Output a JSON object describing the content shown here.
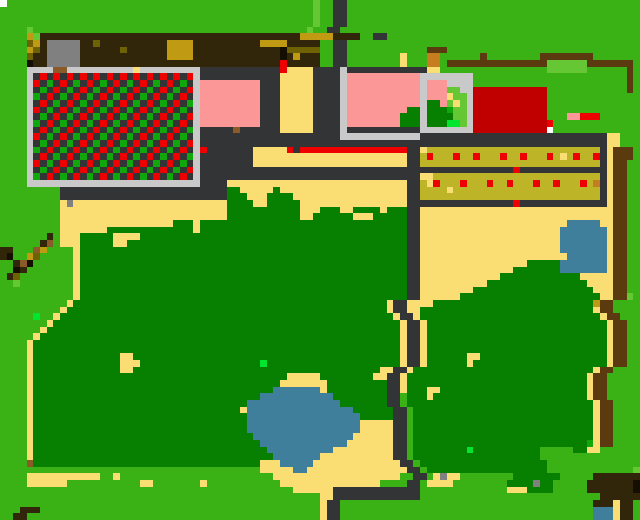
{
  "map": {
    "cols": 96,
    "rows": 78,
    "palette": {
      "G": "#3ab114",
      "D": "#077f00",
      "g": "#10a70d",
      "L": "#66c734",
      "N": "#00e62e",
      "S": "#fbde73",
      "R": "#333436",
      "W": "#c9c9c9",
      "P": "#fb9797",
      "r": "#ee0000",
      "C": "#c00000",
      "o": "#bdb427",
      "d": "#6e6204",
      "m": "#c09a12",
      "B": "#5b3a10",
      "h": "#312609",
      "b": "#8a5a28",
      "K": "#140f02",
      "t": "#808080",
      "U": "#3f7f9c",
      "O": "#c57d20",
      "w": "#ffffff"
    },
    "legend": {
      "G": "grass",
      "D": "forest",
      "g": "green-tile",
      "L": "bush-lime",
      "N": "item-green",
      "S": "sand-path",
      "R": "road-dark",
      "W": "stone-walkway",
      "P": "pink-roof",
      "r": "red-marker",
      "C": "red-building",
      "o": "crop-row",
      "d": "dark-olive",
      "m": "gold-leaf",
      "B": "wood-fence",
      "h": "dark-roof",
      "b": "dirt",
      "K": "shadow",
      "t": "rock-gray",
      "U": "water",
      "O": "crate-orange",
      "w": "map-dot"
    },
    "grid": [
      "wGGGGGGGGGGGGGGGGGGGGGGGGGGGGGGGGGGGGGGGGGGGGGGLGGRRGGGGGGGGGGGGGGGGGGGGGGGGGGGGGGGGGGGGGGGGGGGG",
      "GGGGGGGGGGGGGGGGGGGGGGGGGGGGGGGGGGGGGGGGGGGGGGGLGGRRGGGGGGGGGGGGGGGGGGGGGGGGGGGGGGGGGGGGGGGGGGGG",
      "GGGGGGGGGGGGGGGGGGGGGGGGGGGGGGGGGGGGGGGGGGGGGGGLGGRRGGGGGGGGGGGGGGGGGGGGGGGGGGGGGGGGGGGGGGGGGGGG",
      "GGGGGGGGGGGGGGGGGGGGGGGGGGGGGGGGGGGGGGGGGGGGGGGLGGRRGGGGGGGGGGGGGGGGGGGGGGGGGGGGGGGGGGGGGGGGGGGG",
      "GGGGLGGGGGGGGGGGGGGGGGGGGGGGGGGGGGGGGGGGGGGGGGLGGRRGGGGGGGGGGGGGGGGGGGGGGGGGGGGGGGGGGGGGGGGGGGG",
      "GGGGmLhhhhhhhhhhhhhhhhhhhhhhhhhhhhhhhhhhhhhhhmmmmmhhhhGGRRGGGGGGGGGGGGGGGGGGGGGGGGGGGGGGGGGGGGGGGG",
      "GGGGdmhttttthhdhhhhhhhhhhmmmmhhhhhhhhhhmmmmhhhhhGGRRGGGGGGGGGGGGGGGGGGGGGGGGGGGGGGGGGGGGGGGG",
      "GGGGmdhttttthhhhhhdhhhhhhmmmmhhhhhhhhhhhhhKdddddGGRRGGGGGGGGGGGGBBBGGGGGGGGGGGGGGGGGGGGGGGGGGGGG",
      "GGGGdhhttttthhhhhhhhhhhhhmmmmhhhhhhhhhhhhhKhmhhhGGRRGGGGGGGGSGGGOOGGGGGGBGGGGGGGGBBBBBBBBGGGGGGG",
      "GGGGKhhttttthhhhhhhhhhhhhhhhhhhhhhhhhhhhhhrhhhhhGGRRGGGGGGGGSGGGOOGBBBBBBBBBBBBBBBLLLLLLBBBBBBBG",
      "GGGGWWWWbbWWWWWWWWWWSWWWWWWWWWRRRRRRRRRRRRrSSSSRRRRWRRRRRRRRRRRRSSGGGGGGGGGGGGGGGGLLLLLLGGGGGGBG",
      "GGGGWRrRrRrRrRrRrRrRrRrRrRrRrWRRRRRRRRRRRRSSSSSRRRRWPPPPPPPPPPPWWWWWWWWGGGGGGGGGGGGGGGGGGGGGGGBG",
      "GGGGWrRgRrRgRrRgRrRgRrRgRrRgRWPPPPPPPPPRRRSSSSSRRRRWPPPPPPPPPPPWPPPWWWWGGGGGGGGGGGGGGGGGGGGGGGBG",
      "GGGGWRgRrRgRrRgRrRgRrRgRrRgRrWPPPPPPPPPRRRSSSSSRRRRWPPPPPPPPPPPWPPPLLWWCCCCCCCCCCCGGGGGGGGGGGGBG",
      "GGGGWgRrRgRrRgRrRgRrRgRrRgRrRWPPPPPPPPPRRRSSSSSRRRRWPPPPPPPPPPPWPPPSLLWCCCCCCCCCCCGGGGGGGGGGGGGG",
      "GGGGWRrRgRrRgRrRgRrRgRrRgRrRgWPPPPPPPPPRRRSSSSSRRRRWPPPPPPPPPPPWDDPLSLWCCCCCCCCCCCGGGGGGGGGGGGGG",
      "GGGGWrRgRrRgRrRgRrRgRrRgRrRgRWPPPPPPPPPRRRSSSSSRRRRWPPPPPPPPPDDWDDDgLLWCCCCCCCCCCCGGGGGGGGGGGGGG",
      "GGGGWRgRrRgRrRgRrRgRrRgRrRgRrWPPPPPPPPPRRRSSSSSRRRRWPPPPPPPPDDDWDDDDLLWCCCCCCCCCCCGGGPPrrrGGGGGG",
      "GGGGWgRrRgRrRgRrRgRrRgRrRgRrRWPPPPPPPPPRRRSSSSSRRRRWPPPPPPPPDDDWDDDNNLWCCCCCCCCCCCrGGGGGGGGGGGGG",
      "GGGGWRrRgRrRgRrRgRrRgRrRgRrRgWRRRRRbRRRRRRSSSSSRRRRWRRRRRRRRRRRWWWWWWWWCCCCCCCCCCCwGGGGGGGGGGGGG",
      "GGGGWrRgRrRgRrRgRrRgRrRgRrRgRWRRRRRRRRRRRRRRRRRRRRRWWWWWWWWWWWWRRRRRRRRRRRRRRRRRRRRRRRRRRRRSSGGG",
      "GGGGWRgRrRgRrRgRrRgRrRgRrRgRrWRRRRRRRRRRRRRRRRRRRRRRRRRRRRRRRRRRRRRRRRRRRRRRRRRRRRRRRRRRRRRSSGGG",
      "GGGGWgRrRgRrRgRrRgRrRgRrRgRrRWrRRRRRRRSSSSSrRrrrrrrrrrrrrrrrrRRSooooooooooooooooooooooooooRSBBBG",
      "GGGGWRrRgRrRgRrRgRrRgRrRgRrRgWRRRRRRRRSSSSSSSSSSSSSSSSSSSSSSSRRoroooroorooorooroooroSoroorRSBBBG",
      "GGGGWrRgRrRgRrRgRrRgRrRgRrRgRWRRRRRRRRSSSSSSSSSSSSSSSSSSSSSSSRRoooooooooooooooooooooooooooRSBBGG",
      "GGGGWRgRrRgRrRgRrRgRrRgRrRgRrWRRRRRRRRRRRRRRRRRRRRRRRRRRRRRRRRRRRRRRRRRRRRRRRrRRRRRRRRRRRRRSBBGG",
      "GGGGWgRrRgRrRgRrRgRrRgRrRgRrRWRRRRRRRRRRRRRRRRRRRRRRRRRRRRRRRRRSSoooooooooooooooooooooooooRSBBGG",
      "GGGGWWWWWWWWWWWWWWWWWWWWWWWWWWRRRRSSSSSSSSSSSSSSSSSSSSSSSSSSSRRoSroooroooroorooorooroooroORSBBGG",
      "GGGGGGGGGRRRRRRRRRRRRRRRRRRRRRRRRRDDSSSSSDSSSSSSSSSSSSSSSSSSSRRooooSooooooooooooooooooooooRSBBGG",
      "GGGGGGGGGRRRRRRRRRRRRRRRRRRRRRRRRRDDDSSSDDDDSSSSSSSSSSSSSSSSSRRoooooooooooooooooooooooooooRSBBGG",
      "GGGGGGGGGStSSSSSSSSSSSSSSSSSSSSSSSDDDDSSDDDDDSSSSSSSSSSSSSSSSRRRRRRRRRRRRRRRRrRRRRRRRRRRRRRSBBGG",
      "GGGGGGGGGSSSSSSSSSSSSSSSSSSSSSSSSSDDDDDDDDDDDSSSDDDSSDDDDSDDDRRSSSSSSSSSSSSSSSSSSSSSSSSSSSSSBBGG",
      "GGGGGGGGGSSSSSSSSSSSSSSSSSSSSSSSSSDDDDDDDDDDDSSDDDDDDSSSDDDDDRRSSSSSSSSSSSSSSSSSSSSSSSSSSSSSBBGG",
      "GGGGGGGGGSSSSSSSSSSSSSSSSSDDDSDDDDDDDDDDDDDDDDDDDDDDDDDDDDDDDRRSSSSSSSSSSSSSSSSSSSSSSUUUUUSSBBGG",
      "GGGGGGGGGSSSSSSSDDDDDDDDDDDDDSDDDDDDDDDDDDDDDDDDDDDDDDDDDDDDDRRSSSSSSSSSSSSSSSSSSSSSUUUUUUUSBBGG",
      "GGGGGGGhGSSSDDDDDSSSSDDDDDDDDDDDDDDDDDDDDDDDDDDDDDDDDDDDDDDDDRRSSSSSSSSSSSSSSSSSSSSSUUUUUUUSBBGG",
      "GGGGGGhbGSSSDDDDDSSDDDDDDDDDDDDDDDDDDDDDDDDDDDDDDDDDDDDDDDDDDRRSSSSSSSSSSSSSSSSSSSSSUUUUUUUSBBGG",
      "hhGGGbmGGGGSDDDDDDDDDDDDDDDDDDDDDDDDDDDDDDDDDDDDDDDDDDDDDDDDDRRSSSSSSSSSSSSSSSSSSSSSUUUUUUUSBBGG",
      "hKGGmdGGGGGSDDDDDDDDDDDDDDDDDDDDDDDDDDDDDDDDDDDDDDDDDDDDDDDDDRRSSSSSSSSSSSSSSSSSSSSSSUUUUUUSBBGG",
      "GGhbKGGGGGGSDDDDDDDDDDDDDDDDDDDDDDDDDDDDDDDDDDDDDDDDDDDDDDDDDRRSSSSSSSSSSSSSSSSDDDDDUUUUUUUSBBGG",
      "GGKhGGGGGGGSDDDDDDDDDDDDDDDDDDDDDDDDDDDDDDDDDDDDDDDDDDDDDDDDDRRSSSSSSSSSSSSSSDDDDDDDUUUUUUUSBBGG",
      "GhdGGGGGGGGSDDDDDDDDDDDDDDDDDDDDDDDDDDDDDDDDDDDDDDDDDDDDDDDDDRRSSSSSSSSSSSSDDDDDDDDDDDDSSSSSBBGG",
      "GGLGGGGGGGGSDDDDDDDDDDDDDDDDDDDDDDDDDDDDDDDDDDDDDDDDDDDDDDDDDRRSSSSSSSSSSDDDDDDDDDDDDDDDSSSSBBGG",
      "GGGGGGGGGGGSDDDDDDDDDDDDDDDDDDDDDDDDDDDDDDDDDDDDDDDDDDDDDDDDDRRSSSSSSSSDDDDDDDDDDDDDDDDDDSSSBBGG",
      "GGGGGGGGGGGSDDDDDDDDDDDDDDDDDDDDDDDDDDDDDDDDDDDDDDDDDDDDDDDDDRRSSSSSSDDDDDDDDDDDDDDDDDDDDDSSBBLG",
      "GGGGGGGGGGSDDDDDDDDDDDDDDDDDDDDDDDDDDDDDDDDDDDDDDDDDDDDDDDSRRSSSSDDDDDDDDDDDDDDDDDDDDDDDDmBBGG",
      "GGGGGGGGGSDDDDDDDDDDDDDDDDDDDDDDDDDDDDDDDDDDDDDDDDDDDDDDDDSRRSSDDDDDDDDDDDDDDDDDDDDDDDDDDSBBGG",
      "GGGGGNGGSDDDDDDDDDDDDDDDDDDDDDDDDDDDDDDDDDDDDDDDDDDDDDDDDDDSRRSDDDDDDDDDDDDDDDDDDDDDDDDDDDSBBGG",
      "GGGGGGGSDDDDDDDDDDDDDDDDDDDDDDDDDDDDDDDDDDDDDDDDDDDDDDDDDDDDSRRSDDDDDDDDDDDDDDDDDDDDDDDDDDDSBBGG",
      "GGGGGGSDDDDDDDDDDDDDDDDDDDDDDDDDDDDDDDDDDDDDDDDDDDDDDDDDDDDDSRRSDDDDDDDDDDDDDDDDDDDDDDDDDDDSBBGG",
      "GGGGGSDDDDDDDDDDDDDDDDDDDDDDDDDDDDDDDDDDDDDDDDDDDDDDDDDDDDDDSRRSDDDDDDDDDDDDDDDDDDDDDDDDDDDSBBGG",
      "GGGGSDDDDDDDDDDDDDDDDDDDDDDDDDDDDDDDDDDDDDDDDDDDDDDDDDDDDDDDSRRSDDDDDDDDDDDDDDDDDDDDDDDDDDDSBBGG",
      "GGGGSDDDDDDDDDDDDDDDDDDDDDDDDDDDDDDDDDDDDDDDDDDDDDDDDDDDDDDDSRRSDDDDDDDDDDDDDDDDDDDDDDDDDDDSBBGG",
      "GGGGSDDDDDDDDDDDDDSSDDDDDDDDDDDDDDDDDDDDDDDDDDDDDDDDDDDDDDDDSRRSDDDDDDSSDDDDDDDDDDDDDDDDDDDSBBGG",
      "GGGGSDDDDDDDDDDDDDSSSDDDDDDDDDDDDDDDDDDNDDDDDDDDDDDDDDDDDDDDSRRSDDDDDDSDDDDDDDDDDDDDDDDDDDDSBBGG",
      "GGGGSDDDDDDDDDDDDDSSDDDDDDDDDDDDDDDDDDDDDDDDDDDDDDDDDDDDDSSRRSDDDDDDDDDDDDDDDDDDDDDDDDDDDSBBGG",
      "GGGGSDDDDDDDDDDDDDDDDDDDDDDDDDDDDDDDDDDDDDDSSSSSDDDDDDDDSSRRSDDDDDDDDDDDDDDDDDDDDDDDDDDDSBBGG",
      "GGGGSDDDDDDDDDDDDDDDDDDDDDDDDDDDDDDDDDDDDDSSSSSSSDDDDDDDDDRRSDDDDDDDDDDDDDDDDDDDDDDDDDDDSBBGG",
      "GGGGSDDDDDDDDDDDDDDDDDDDDDDDDDDDDDDDDDDDDUUUUUUUSDDDDDDDDDRRSDDDSSDDDDDDDDDDDDDDDDDDDDDDSBBGG",
      "GGGGSDDDDDDDDDDDDDDDDDDDDDDDDDDDDDDDDDDUUUUUUUUUUUDDDDDDDDRRGDDDSDDDDDDDDDDDDDDDDDDDDDDDSBBGG",
      "GGGGSDDDDDDDDDDDDDDDDDDDDDDDDDDDDDDDDUUUUUUUUUUUUUUDDDDDDDRRGDDDDDDDDDDDDDDDDDDDDDDDDDDDDSBBGG",
      "GGGGSDDDDDDDDDDDDDDDDDDDDDDDDDDDDDDDSUUUUUUUUUUUUUUUUDDDDDDRRGDDDDDDDDDDDDDDDDDDDDDDDDDDDSBBGG",
      "GGGGSDDDDDDDDDDDDDDDDDDDDDDDDDDDDDDDDUUUUUUUUUUUUUUUUUDDDDDRRGDDDDDDDDDDDDDDDDDDDDDDDDDDDSBBGG",
      "GGGGSDDDDDDDDDDDDDDDDDDDDDDDDDDDDDDDDUUUUUUUUUUUUUUUUUSSSSSRRGDDDDDDDDDDDDDDDDDDDDDDDDDDDSBBGG",
      "GGGGSDDDDDDDDDDDDDDDDDDDDDDDDDDDDDDDDUUUUUUUUUUUUUUUUUSSSSSRRGDDDDDDDDDDDDDDDDDDDDDDDDDDDSBBGG",
      "GGGGSDDDDDDDDDDDDDDDDDDDDDDDDDDDDDDDDDUUUUUUUUUUUUUUUSSSSSSRRGDDDDDDDDDDDDDDDDDDDDDDDDDDDSBBGG",
      "GGGGSDDDDDDDDDDDDDDDDDDDDDDDDDDDDDDDDDDUUUUUUUUUUUUUSSSSSSSRRGDDDDDDDDDDDDDDDDDDDDDDDDDDgSBBGG",
      "GGGGSDDDDDDDDDDDDDDDDDDDDDDDDDDDDDDDDDDDUUUUUUUUUUSSSSSSSSSRRGDDDDDDDDNDDDDDDDDDDGGGGGDDSSGGGG",
      "GGGGSDDDDDDDDDDDDDDDDDDDDDDDDDDDDDDDDDDDDUUUUUUUSSSSSSSSSSSRRGDDDDDDDDDDDDDDDDDDDGGGGGGGGGGGGG",
      "GGGGbDDDDDDDDDDDDDDDDDDDDDDDDDDDDDDDDDDSSSUUUUUSSSSSSSSSSSSSRRGDDDDDDDDDDDDDDDDDDDGGGGGGGGGGGGG",
      "GGGGGGGGGGGGGGGGGGGGGGGGGGGGGGGGGGGGGGGSSSSSUUSSSSSSSSSSSSSSSRRGDDDDDDDDDDDDDDDDDDGGGGGGGGGGGGGL",
      "GGGGSSSSSSSSSSSGGSGGGGGGGGGGGGGGGGGGGGGGGSSSSSSSSSSSSSSSSSSSGGRRGStSSGGGGGGGGDDDDDDDGGGGGhhhhhhhh",
      "GGGGSSSSSSGGGGGGGGGGGSSGGGGGGGSGGGGGGGGGGGSSSSSSSSSSSSSSSGGGGRRGSSSSGGGGGGGGDDDDtDDGGGGGhhhhhhhK",
      "GGGGGGGGGGGGGGGGGGGGGGGGGGGGGGGGGGGGGGGGGGGGSSSSSSRRRRRRRRRRRRRGGGGGGGGGGGGGSSSDDDDGGGGGhhhhhhhK",
      "GGGGGGGGGGGGGGGGGGGGGGGGGGGGGGGGGGGGGGGGGGGGGGGGSSRRRRRRRRRRRRRGGGGGGGGGGGGGGGGGGGGGGGGGGGhhhhhh",
      "GGGGGGGGGGGGGGGGGGGGGGGGGGGGGGGGGGGGGGGGGGGGGGGGSRRGGGGGGGGGGGGGGGGGGGGGGGGGGGGGGGGGGGGGGhhhShh",
      "GGGhhhGGGGGGGGGGGGGGGGGGGGGGGGGGGGGGGGGGGGGGGGGGSRRGGGGGGGGGGGGGGGGGGGGGGGGGGGGGGGGGGGGGGUUUShh",
      "GGhhGGGGGGGGGGGGGGGGGGGGGGGGGGGGGGGGGGGGGGGGGGGGSRRGGGGGGGGGGGGGGGGGGGGGGGGGGGGGGGGGGGGGGUUUShh"
    ]
  },
  "screen": {
    "width": 640,
    "height": 520,
    "title": "pixel-world-map"
  }
}
